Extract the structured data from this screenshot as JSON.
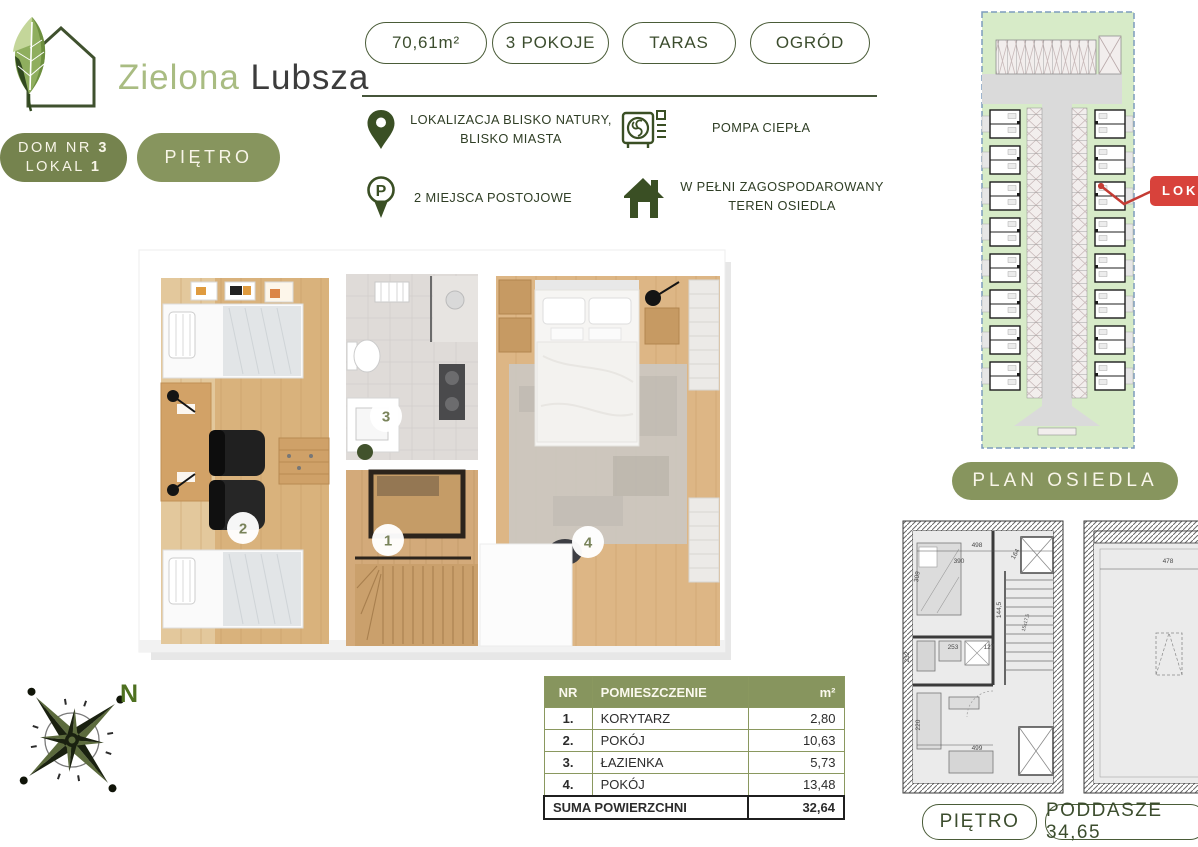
{
  "logo": {
    "word1": "Zielona",
    "word2": "Lubsza"
  },
  "badges": {
    "house_l1_prefix": "DOM NR ",
    "house_l1_num": "3",
    "house_l2_prefix": "LOKAL ",
    "house_l2_num": "1",
    "floor": "PIĘTRO"
  },
  "spec_pills": {
    "area": "70,61m²",
    "rooms": "3 POKOJE",
    "terrace": "TARAS",
    "garden": "OGRÓD"
  },
  "features": {
    "location": {
      "line1": "LOKALIZACJA BLISKO NATURY,",
      "line2": "BLISKO MIASTA"
    },
    "heat_pump": {
      "line1": "POMPA CIEPŁA"
    },
    "parking": {
      "line1": "2 MIEJSCA POSTOJOWE"
    },
    "estate": {
      "line1": "W PEŁNI ZAGOSPODAROWANY",
      "line2": "TEREN OSIEDLA"
    }
  },
  "floor_plan": {
    "m1": "1",
    "m2": "2",
    "m3": "3",
    "m4": "4"
  },
  "compass": {
    "north": "N"
  },
  "rooms_table": {
    "headers": {
      "nr": "NR",
      "name": "POMIESZCZENIE",
      "area": "m²"
    },
    "rows": [
      {
        "nr": "1.",
        "name": "KORYTARZ",
        "area": "2,80"
      },
      {
        "nr": "2.",
        "name": "POKÓJ",
        "area": "10,63"
      },
      {
        "nr": "3.",
        "name": "ŁAZIENKA",
        "area": "5,73"
      },
      {
        "nr": "4.",
        "name": "POKÓJ",
        "area": "13,48"
      }
    ],
    "footer": {
      "label": "SUMA POWIERZCHNI",
      "value": "32,64"
    }
  },
  "site_plan": {
    "button": "PLAN OSIEDLA",
    "callout": "LOK"
  },
  "tech_plans": {
    "floor_pill": "PIĘTRO",
    "attic_pill": "PODDASZE 34,65",
    "dims": {
      "d498": "498",
      "d390": "390",
      "d164": "164",
      "d1445": "144,5",
      "d253": "253",
      "d127": "127",
      "d309": "309",
      "d232": "232",
      "d220": "220",
      "d499": "499",
      "dstairs": "15x17,5",
      "d478": "478"
    }
  },
  "colors": {
    "olive": "#87955e",
    "olive_dark": "#75834e",
    "green_dark": "#3a4f24",
    "green_logo": "#a9bc82",
    "cream": "#f8f5e8",
    "red": "#d8423b",
    "plan_green": "#d7ebc8",
    "table_border": "#8a985f"
  }
}
